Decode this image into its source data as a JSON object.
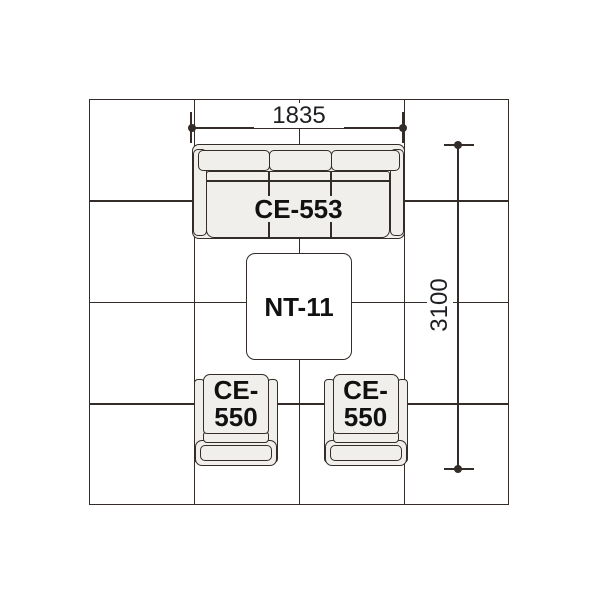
{
  "diagram": {
    "type": "furniture-layout-plan",
    "grid": {
      "columns": 4,
      "rows": 4
    },
    "dimensions": {
      "width": {
        "value": "1835"
      },
      "depth": {
        "value": "3100"
      }
    },
    "furniture": {
      "sofa": {
        "label": "CE-553",
        "back_cushions": 3,
        "seat_sections": 3
      },
      "table": {
        "label": "NT-11"
      },
      "chair_left": {
        "label_line1": "CE-",
        "label_line2": "550"
      },
      "chair_right": {
        "label_line1": "CE-",
        "label_line2": "550"
      }
    },
    "colors": {
      "background": "#ffffff",
      "line": "#332c28",
      "furniture_fill": "#f0efec",
      "table_fill": "#ffffff",
      "label_text": "#111111",
      "dimension_text": "#1f1f23"
    }
  }
}
